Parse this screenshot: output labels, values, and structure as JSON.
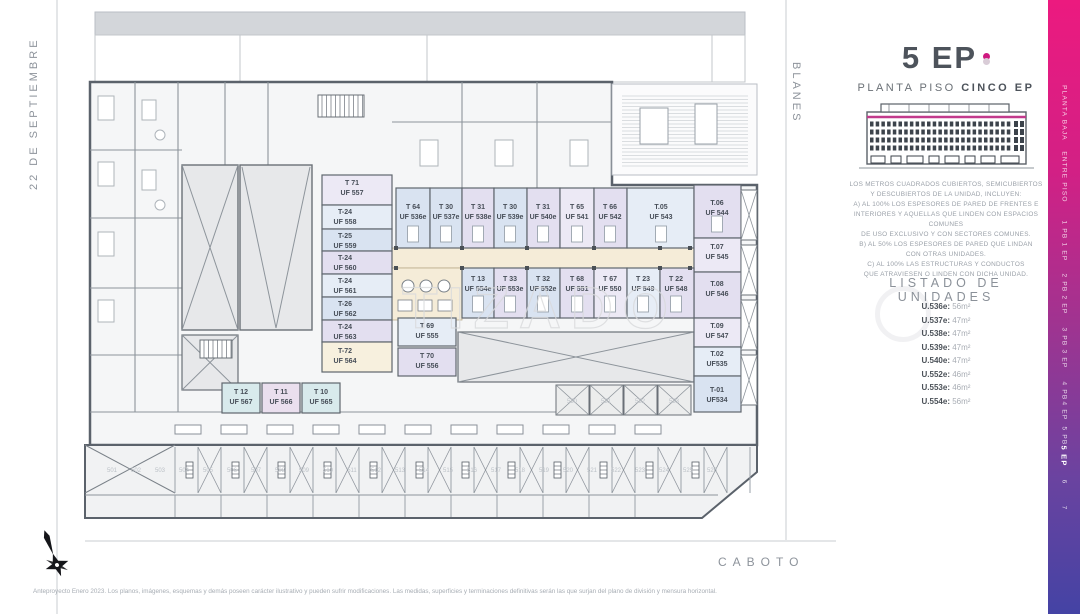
{
  "streets": {
    "left": "22 DE SEPTIEMBRE",
    "right": "BLANES",
    "bottom": "CABOTO"
  },
  "panel": {
    "title": "5 EP",
    "subtitle_regular": "PLANTA PISO ",
    "subtitle_bold": "CINCO EP",
    "description_lines": [
      "LOS METROS CUADRADOS CUBIERTOS, SEMICUBIERTOS",
      "Y DESCUBIERTOS DE LA UNIDAD, INCLUYEN:",
      "A) AL 100% LOS ESPESORES DE PARED DE FRENTES E",
      "INTERIORES Y AQUELLAS QUE LINDEN CON ESPACIOS COMUNES",
      "DE USO EXCLUSIVO Y CON SECTORES COMUNES.",
      "B) AL 50% LOS ESPESORES DE PARED QUE LINDAN",
      "CON OTRAS UNIDADES.",
      "C) AL 100% LAS ESTRUCTURAS Y CONDUCTOS",
      "QUE ATRAVIESEN O LINDEN CON DICHA UNIDAD."
    ],
    "listado_title": "LISTADO DE UNIDADES",
    "unidades": [
      {
        "label": "U.536e:",
        "area": "56m²"
      },
      {
        "label": "U.537e:",
        "area": "47m²"
      },
      {
        "label": "U.538e:",
        "area": "47m²"
      },
      {
        "label": "U.539e:",
        "area": "47m²"
      },
      {
        "label": "U.540e:",
        "area": "47m²"
      },
      {
        "label": "U.552e:",
        "area": "46m²"
      },
      {
        "label": "U.553e:",
        "area": "46m²"
      },
      {
        "label": "U.554e:",
        "area": "56m²"
      }
    ]
  },
  "floor_selector": {
    "items": [
      "PLANTA BAJA",
      "ENTRE PISO",
      "1 PB",
      "1 EP",
      "2 PB",
      "2 EP",
      "3 PB",
      "3 EP",
      "4 PB",
      "4 EP",
      "5 PB",
      "5 EP",
      "6",
      "7"
    ],
    "active": "5 EP"
  },
  "plan": {
    "watermark": "TIZADO",
    "units": [
      {
        "type": "T 64",
        "uf": "UF 536e"
      },
      {
        "type": "T 30",
        "uf": "UF 537e"
      },
      {
        "type": "T 31",
        "uf": "UF 538e"
      },
      {
        "type": "T 30",
        "uf": "UF 539e"
      },
      {
        "type": "T 31",
        "uf": "UF 540e"
      },
      {
        "type": "T 65",
        "uf": "UF 541"
      },
      {
        "type": "T 66",
        "uf": "UF 542"
      },
      {
        "type": "T.05",
        "uf": "UF 543"
      },
      {
        "type": "T.06",
        "uf": "UF 544"
      },
      {
        "type": "T.07",
        "uf": "UF 545"
      },
      {
        "type": "T.08",
        "uf": "UF 546"
      },
      {
        "type": "T.09",
        "uf": "UF 547"
      },
      {
        "type": "T.02",
        "uf": "UF535"
      },
      {
        "type": "T-01",
        "uf": "UF534"
      },
      {
        "type": "T 13",
        "uf": "UF 554e"
      },
      {
        "type": "T 33",
        "uf": "UF 553e"
      },
      {
        "type": "T 32",
        "uf": "UF 552e"
      },
      {
        "type": "T 68",
        "uf": "UF 551"
      },
      {
        "type": "T 67",
        "uf": "UF 550"
      },
      {
        "type": "T 23",
        "uf": "UF 549"
      },
      {
        "type": "T 22",
        "uf": "UF 548"
      },
      {
        "type": "T 71",
        "uf": "UF 557"
      },
      {
        "type": "T-24",
        "uf": "UF 558"
      },
      {
        "type": "T-25",
        "uf": "UF 559"
      },
      {
        "type": "T-24",
        "uf": "UF 560"
      },
      {
        "type": "T-24",
        "uf": "UF 561"
      },
      {
        "type": "T-26",
        "uf": "UF 562"
      },
      {
        "type": "T-24",
        "uf": "UF 563"
      },
      {
        "type": "T-72",
        "uf": "UF 564"
      },
      {
        "type": "T 69",
        "uf": "UF 555"
      },
      {
        "type": "T 70",
        "uf": "UF 556"
      },
      {
        "type": "T 12",
        "uf": "UF 567"
      },
      {
        "type": "T 11",
        "uf": "UF 566"
      },
      {
        "type": "T 10",
        "uf": "UF 565"
      }
    ],
    "storage_numbers": [
      "501",
      "502",
      "503",
      "504",
      "505",
      "506",
      "507",
      "508",
      "509",
      "510",
      "511",
      "512",
      "513",
      "514",
      "515",
      "516",
      "517",
      "518",
      "519",
      "520",
      "521",
      "522",
      "523",
      "524",
      "525",
      "526"
    ],
    "mid_storage_numbers": [
      "530",
      "531",
      "532",
      "533"
    ]
  },
  "footer": {
    "disclaimer": "Anteproyecto Enero 2023. Los planos, imágenes, esquemas y demás poseen carácter ilustrativo y pueden sufrir modificaciones. Las medidas, superficies y terminaciones definitivas serán las que surjan del plano de división y mensura horizontal."
  },
  "colors": {
    "accent": "#cf1980",
    "gradient_top": "#ec1a7f",
    "gradient_bottom": "#4443a4"
  }
}
